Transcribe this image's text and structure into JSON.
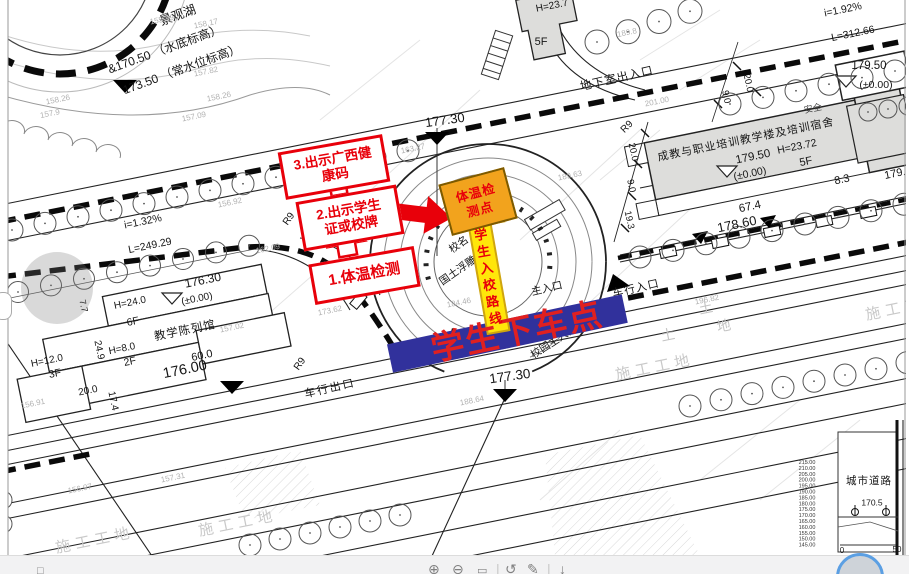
{
  "annotations": {
    "steps": [
      {
        "lines": [
          "1.体温检测"
        ]
      },
      {
        "lines": [
          "2.出示学生",
          "证或校牌"
        ]
      },
      {
        "lines": [
          "3.出示广西健",
          "康码"
        ]
      }
    ],
    "checkpoint": {
      "lines": [
        "体温检",
        "测点"
      ]
    },
    "route_label": "学生入校路线",
    "dropoff_label": "学生下车点",
    "colors": {
      "red": "#e8000a",
      "bar_blue": "#31319c",
      "orange": "#f2a31d",
      "yellow": "#ffe60a"
    }
  },
  "plan": {
    "labels": [
      {
        "t": "景观湖",
        "x": 178,
        "y": 16,
        "r": -20,
        "s": 12.5
      },
      {
        "t": "&170.50 （水底标高）",
        "x": 165,
        "y": 50,
        "r": -20,
        "s": 12
      },
      {
        "t": "173.50 （常水位标高）",
        "x": 182,
        "y": 70,
        "r": -20,
        "s": 12
      },
      {
        "t": "i=1.32%",
        "x": 143,
        "y": 222,
        "r": -11.5,
        "s": 10.5
      },
      {
        "t": "L=249.29",
        "x": 150,
        "y": 246,
        "r": -11.5,
        "s": 10.5
      },
      {
        "t": "R9",
        "x": 289,
        "y": 219,
        "r": -55,
        "s": 10
      },
      {
        "t": "R9",
        "x": 300,
        "y": 364,
        "r": -55,
        "s": 10
      },
      {
        "t": "R9",
        "x": 627,
        "y": 127,
        "r": -45,
        "s": 10
      },
      {
        "t": "176.30",
        "x": 203,
        "y": 281,
        "r": -11.5,
        "s": 12
      },
      {
        "t": "H=24.0",
        "x": 130,
        "y": 303,
        "r": -11.5,
        "s": 10
      },
      {
        "t": "(±0.00)",
        "x": 197,
        "y": 299,
        "r": -11.5,
        "s": 10
      },
      {
        "t": "6F",
        "x": 133,
        "y": 322,
        "r": -11.5,
        "s": 10.5
      },
      {
        "t": "教学陈列馆",
        "x": 185,
        "y": 331,
        "r": -11.5,
        "s": 11.5,
        "ls": 1
      },
      {
        "t": "H=8.0",
        "x": 122,
        "y": 349,
        "r": -11.5,
        "s": 10
      },
      {
        "t": "2F",
        "x": 130,
        "y": 362,
        "r": -11.5,
        "s": 10.5
      },
      {
        "t": "H=12.0",
        "x": 47,
        "y": 361,
        "r": -11.5,
        "s": 10
      },
      {
        "t": "3F",
        "x": 55,
        "y": 374,
        "r": -11.5,
        "s": 10.5
      },
      {
        "t": "24.9",
        "x": 99,
        "y": 350,
        "r": 78,
        "s": 10
      },
      {
        "t": "7.7",
        "x": 83,
        "y": 306,
        "r": 78,
        "s": 9
      },
      {
        "t": "20.0",
        "x": 88,
        "y": 391,
        "r": -11.5,
        "s": 10
      },
      {
        "t": "17.4",
        "x": 113,
        "y": 401,
        "r": 78,
        "s": 10
      },
      {
        "t": "60.0",
        "x": 202,
        "y": 356,
        "r": -11.5,
        "s": 11
      },
      {
        "t": "176.00",
        "x": 185,
        "y": 370,
        "r": -11.5,
        "s": 14.5
      },
      {
        "t": "车行出口",
        "x": 330,
        "y": 389,
        "r": -13,
        "s": 11,
        "ls": 2
      },
      {
        "t": "177.30",
        "x": 445,
        "y": 121,
        "r": -8,
        "s": 13
      },
      {
        "t": "177.30",
        "x": 510,
        "y": 377,
        "r": -8,
        "s": 13.5
      },
      {
        "t": "校名",
        "x": 459,
        "y": 245,
        "r": -35,
        "s": 10.5
      },
      {
        "t": "国土浮雕",
        "x": 458,
        "y": 271,
        "r": -35,
        "s": 10.5
      },
      {
        "t": "主入口",
        "x": 547,
        "y": 289,
        "r": -13,
        "s": 10.5
      },
      {
        "t": "校园主入口",
        "x": 554,
        "y": 342,
        "r": -33,
        "s": 10.5
      },
      {
        "t": "车行入口",
        "x": 636,
        "y": 289,
        "r": -13,
        "s": 11,
        "ls": 1
      },
      {
        "t": "地下室出入口",
        "x": 617,
        "y": 79,
        "r": -13,
        "s": 11.5,
        "ls": 1
      },
      {
        "t": "H=23.7",
        "x": 552,
        "y": 6,
        "r": -11,
        "s": 10
      },
      {
        "t": "5F",
        "x": 541,
        "y": 42,
        "r": 0,
        "s": 11
      },
      {
        "t": "成教与职业培训教学楼及培训宿舍",
        "x": 746,
        "y": 140,
        "r": -11.5,
        "s": 11,
        "ls": 1
      },
      {
        "t": "179.50",
        "x": 753,
        "y": 157,
        "r": -11.5,
        "s": 11.5
      },
      {
        "t": "H=23.72",
        "x": 797,
        "y": 147,
        "r": -11.5,
        "s": 10.5
      },
      {
        "t": "(±0.00)",
        "x": 750,
        "y": 174,
        "r": -11.5,
        "s": 10.5
      },
      {
        "t": "5F",
        "x": 806,
        "y": 162,
        "r": -11.5,
        "s": 11
      },
      {
        "t": "67.4",
        "x": 750,
        "y": 207,
        "r": -11.5,
        "s": 11.5
      },
      {
        "t": "178.60",
        "x": 737,
        "y": 225,
        "r": -11.5,
        "s": 13
      },
      {
        "t": "8.3",
        "x": 842,
        "y": 180,
        "r": -11.5,
        "s": 11
      },
      {
        "t": "179.",
        "x": 895,
        "y": 174,
        "r": -11.5,
        "s": 11
      },
      {
        "t": "20.0",
        "x": 633,
        "y": 152,
        "r": 78,
        "s": 9.5
      },
      {
        "t": "9.0",
        "x": 631,
        "y": 186,
        "r": 78,
        "s": 9.5
      },
      {
        "t": "19.3",
        "x": 629,
        "y": 220,
        "r": 78,
        "s": 9.5
      },
      {
        "t": "i=1.92%",
        "x": 843,
        "y": 10,
        "r": -11.5,
        "s": 10.5
      },
      {
        "t": "L=312.66",
        "x": 853,
        "y": 34,
        "r": -11.5,
        "s": 10.5
      },
      {
        "t": "20.0",
        "x": 748,
        "y": 83,
        "r": 78,
        "s": 9.5
      },
      {
        "t": "9.0",
        "x": 726,
        "y": 97,
        "r": 78,
        "s": 9.5
      },
      {
        "t": "179.50",
        "x": 869,
        "y": 66,
        "r": 0,
        "s": 11.5
      },
      {
        "t": "(±0.00)",
        "x": 876,
        "y": 85,
        "r": 0,
        "s": 10.5
      },
      {
        "t": "安全",
        "x": 813,
        "y": 109,
        "r": -11.5,
        "s": 9,
        "c": "#444444"
      },
      {
        "t": "城市道路",
        "x": 869,
        "y": 481,
        "r": 0,
        "s": 10.5,
        "ls": 1
      },
      {
        "t": "170.5",
        "x": 872,
        "y": 503,
        "r": 0,
        "s": 8.5
      },
      {
        "t": "0",
        "x": 842,
        "y": 551,
        "r": 0,
        "s": 8
      },
      {
        "t": "50",
        "x": 897,
        "y": 550,
        "r": 0,
        "s": 8
      },
      {
        "t": "155.39",
        "x": 162,
        "y": 20,
        "r": -11.5,
        "s": 8,
        "c": "#b2b2b2"
      },
      {
        "t": "158.17",
        "x": 206,
        "y": 24,
        "r": -11.5,
        "s": 8,
        "c": "#b2b2b2"
      },
      {
        "t": "157.82",
        "x": 206,
        "y": 72,
        "r": -11.5,
        "s": 8,
        "c": "#b2b2b2"
      },
      {
        "t": "158.26",
        "x": 219,
        "y": 97,
        "r": -11.5,
        "s": 8,
        "c": "#b2b2b2"
      },
      {
        "t": "157.09",
        "x": 194,
        "y": 117,
        "r": -11.5,
        "s": 8,
        "c": "#b2b2b2"
      },
      {
        "t": "158.26",
        "x": 58,
        "y": 100,
        "r": -11.5,
        "s": 8,
        "c": "#b2b2b2"
      },
      {
        "t": "157.9",
        "x": 50,
        "y": 114,
        "r": -11.5,
        "s": 8,
        "c": "#b2b2b2"
      },
      {
        "t": "156.92",
        "x": 230,
        "y": 203,
        "r": -11.5,
        "s": 8,
        "c": "#b2b2b2"
      },
      {
        "t": "162.09",
        "x": 268,
        "y": 249,
        "r": -11.5,
        "s": 8,
        "c": "#b2b2b2"
      },
      {
        "t": "163.27",
        "x": 413,
        "y": 149,
        "r": -11.5,
        "s": 8,
        "c": "#b2b2b2"
      },
      {
        "t": "173.62",
        "x": 330,
        "y": 311,
        "r": -11.5,
        "s": 8,
        "c": "#b2b2b2"
      },
      {
        "t": "189.63",
        "x": 570,
        "y": 176,
        "r": -11.5,
        "s": 8,
        "c": "#b2b2b2"
      },
      {
        "t": "189.8",
        "x": 627,
        "y": 33,
        "r": -11.5,
        "s": 8,
        "c": "#b2b2b2"
      },
      {
        "t": "201.00",
        "x": 657,
        "y": 102,
        "r": -11.5,
        "s": 8,
        "c": "#b2b2b2"
      },
      {
        "t": "196.82",
        "x": 707,
        "y": 300,
        "r": -11.5,
        "s": 8,
        "c": "#b2b2b2"
      },
      {
        "t": "184.46",
        "x": 459,
        "y": 303,
        "r": -11.5,
        "s": 8,
        "c": "#b2b2b2"
      },
      {
        "t": "188.64",
        "x": 472,
        "y": 401,
        "r": -11.5,
        "s": 8,
        "c": "#b2b2b2"
      },
      {
        "t": "157.02",
        "x": 232,
        "y": 328,
        "r": -11.5,
        "s": 8,
        "c": "#b2b2b2"
      },
      {
        "t": "156.91",
        "x": 33,
        "y": 404,
        "r": -11.5,
        "s": 8,
        "c": "#b2b2b2"
      },
      {
        "t": "156.97",
        "x": 80,
        "y": 489,
        "r": -11.5,
        "s": 8,
        "c": "#b2b2b2"
      },
      {
        "t": "157.31",
        "x": 173,
        "y": 478,
        "r": -11.5,
        "s": 8,
        "c": "#b2b2b2"
      },
      {
        "t": "施工工地",
        "x": 95,
        "y": 541,
        "r": -11.5,
        "s": 15,
        "c": "#c9c9c9",
        "ls": 5
      },
      {
        "t": "施工工地",
        "x": 238,
        "y": 524,
        "r": -11.5,
        "s": 15,
        "c": "#c9c9c9",
        "ls": 5
      },
      {
        "t": "施工工地",
        "x": 655,
        "y": 368,
        "r": -11.5,
        "s": 15,
        "c": "#c9c9c9",
        "ls": 5
      },
      {
        "t": "施工工地",
        "x": 905,
        "y": 308,
        "r": -11.5,
        "s": 15,
        "c": "#c9c9c9",
        "ls": 5
      },
      {
        "t": "土",
        "x": 668,
        "y": 336,
        "r": -11.5,
        "s": 14,
        "c": "#c4c4c4"
      },
      {
        "t": "土",
        "x": 706,
        "y": 309,
        "r": -11.5,
        "s": 14,
        "c": "#c4c4c4"
      },
      {
        "t": "地",
        "x": 724,
        "y": 327,
        "r": -11.5,
        "s": 14,
        "c": "#c4c4c4"
      }
    ],
    "profile": {
      "scale_values": [
        "215.00",
        "210.00",
        "205.00",
        "200.00",
        "195.00",
        "190.00",
        "185.00",
        "180.00",
        "175.00",
        "170.00",
        "165.00",
        "160.00",
        "155.00",
        "150.00",
        "145.00"
      ]
    }
  },
  "viewer": {
    "toolbar": {
      "icons": [
        {
          "name": "select",
          "glyph": "□"
        },
        {
          "name": "zoom-in",
          "glyph": "⊕"
        },
        {
          "name": "zoom-out",
          "glyph": "⊖"
        },
        {
          "name": "fit",
          "glyph": "▭"
        },
        {
          "name": "divider",
          "glyph": "|"
        },
        {
          "name": "rotate",
          "glyph": "↺"
        },
        {
          "name": "edit",
          "glyph": "✎"
        },
        {
          "name": "divider",
          "glyph": "|"
        },
        {
          "name": "download",
          "glyph": "↓"
        }
      ]
    }
  }
}
